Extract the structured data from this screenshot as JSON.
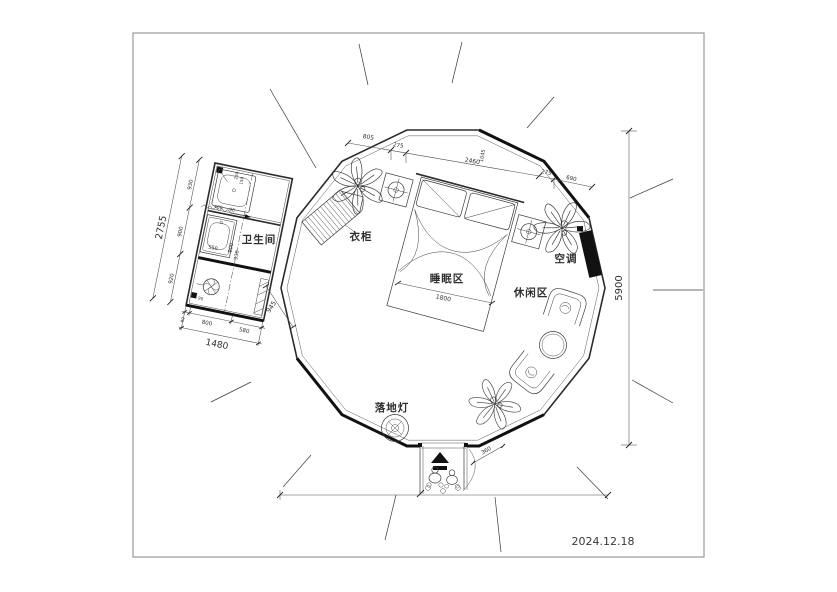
{
  "drawing": {
    "date": "2024.12.18",
    "rooms": {
      "bathroom": "卫生间",
      "sleeping": "睡眠区",
      "leisure": "休闲区"
    },
    "items": {
      "wardrobe": "衣柜",
      "ac": "空调",
      "floor_lamp": "落地灯"
    },
    "dims": {
      "overall_h": "5900",
      "bath_total_h": "2755",
      "bath_total_w": "1480",
      "bath_left": [
        "930",
        "900",
        "920"
      ],
      "bath_bottom": [
        "90",
        "800",
        "580"
      ],
      "bath_inner": {
        "sink": "550",
        "mid_a": "900",
        "mid_b": "930",
        "shower_a": "400",
        "shower_b": "90",
        "shower_c": "250",
        "shower_d": "150",
        "toilet": "90"
      },
      "top": [
        "805",
        "275",
        "2460",
        "1045",
        "275",
        "690"
      ],
      "bed_w": "1800",
      "entry": "360",
      "passage": "945"
    }
  }
}
